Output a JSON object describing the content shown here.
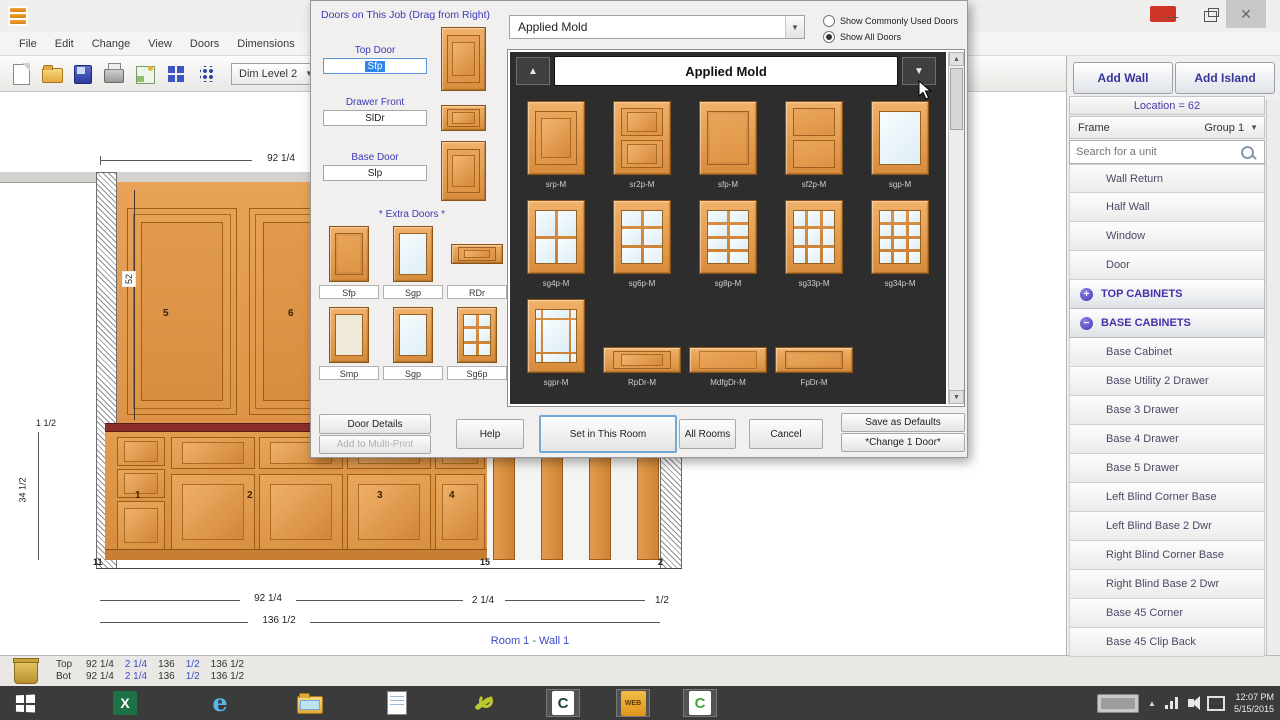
{
  "window": {
    "menu": [
      "File",
      "Edit",
      "Change",
      "View",
      "Doors",
      "Dimensions",
      "C-T"
    ],
    "toolbar": {
      "dim_level": "Dim Level 2",
      "icons": [
        "new-document",
        "open-folder",
        "save-project",
        "print",
        "preview",
        "door-catalog",
        "settings-dots"
      ]
    },
    "controls": {
      "minimize": "—",
      "close": "✕"
    }
  },
  "dialog": {
    "title": "Doors on This Job (Drag from Right)",
    "fields": [
      {
        "label": "Top Door",
        "value": "Sfp"
      },
      {
        "label": "Drawer Front",
        "value": "SlDr"
      },
      {
        "label": "Base Door",
        "value": "Slp"
      }
    ],
    "extra_doors_title": "* Extra Doors *",
    "extra_doors": [
      {
        "label": "Sfp",
        "style": "flat"
      },
      {
        "label": "Sgp",
        "style": "glass"
      },
      {
        "label": "RDr",
        "style": "drawer-raised"
      },
      {
        "label": "Smp",
        "style": "panel-light"
      },
      {
        "label": "Sgp",
        "style": "glass"
      },
      {
        "label": "Sg6p",
        "style": "glassgrid",
        "panes": [
          2,
          3
        ]
      }
    ],
    "left_buttons": [
      {
        "label": "Door Details"
      },
      {
        "label": "Add to Multi-Print"
      }
    ],
    "style_dropdown": "Applied Mold",
    "radios": [
      {
        "label": "Show Commonly Used Doors",
        "checked": false
      },
      {
        "label": "Show All Doors",
        "checked": true
      }
    ],
    "catalog": {
      "header": "Applied Mold",
      "doors": [
        {
          "label": "srp-M",
          "style": "raised"
        },
        {
          "label": "sr2p-M",
          "style": "raised2"
        },
        {
          "label": "sfp-M",
          "style": "flat"
        },
        {
          "label": "sf2p-M",
          "style": "flat2"
        },
        {
          "label": "sgp-M",
          "style": "glass"
        },
        {
          "label": "sg4p-M",
          "style": "glassgrid",
          "panes": [
            2,
            2
          ]
        },
        {
          "label": "sg6p-M",
          "style": "glassgrid",
          "panes": [
            2,
            3
          ]
        },
        {
          "label": "sg8p-M",
          "style": "glassgrid",
          "panes": [
            2,
            4
          ]
        },
        {
          "label": "sg33p-M",
          "style": "glassgrid",
          "panes": [
            3,
            3
          ]
        },
        {
          "label": "sg34p-M",
          "style": "glassgrid",
          "panes": [
            3,
            4
          ]
        },
        {
          "label": "sgpr-M",
          "style": "prairie"
        },
        {
          "label": "RpDr-M",
          "style": "drawer-raised"
        },
        {
          "label": "MdfgDr-M",
          "style": "drawer-slab"
        },
        {
          "label": "FpDr-M",
          "style": "drawer-flat"
        }
      ]
    },
    "bottom_buttons": [
      {
        "label": "Help"
      },
      {
        "label": "Set in This Room"
      },
      {
        "label": "All Rooms"
      },
      {
        "label": "Cancel"
      }
    ],
    "right_buttons": [
      {
        "label": "Save as Defaults"
      },
      {
        "label": "*Change 1 Door*"
      }
    ]
  },
  "sidebar": {
    "add_wall": "Add Wall",
    "add_island": "Add Island",
    "location": "Location = 62",
    "frame_label": "Frame",
    "group": "Group 1",
    "search_placeholder": "Search for a unit",
    "items": [
      "Wall Return",
      "Half Wall",
      "Window",
      "Door"
    ],
    "sections": [
      {
        "label": "TOP CABINETS",
        "expanded": false,
        "items": []
      },
      {
        "label": "BASE CABINETS",
        "expanded": true,
        "items": [
          "Base Cabinet",
          "Base Utility 2 Drawer",
          "Base 3 Drawer",
          "Base 4 Drawer",
          "Base 5 Drawer",
          "Left Blind Corner Base",
          "Left Blind Base 2 Dwr",
          "Right Blind Corner Base",
          "Right Blind Base 2 Dwr",
          "Base 45 Corner",
          "Base 45 Clip Back"
        ]
      }
    ]
  },
  "drawing": {
    "top_dim": "92 1/4",
    "upper_height_label": "52",
    "counter_dim": "1 1/2",
    "base_height_dim": "34 1/2",
    "inner_base_label": "34 1/2",
    "upper_numbers": [
      "5",
      "6"
    ],
    "base_numbers": [
      "1",
      "2",
      "3",
      "4"
    ],
    "floor_labels": [
      "11",
      "15",
      "2"
    ],
    "bottom_dim1": "92 1/4",
    "bottom_dim2": "2 1/4",
    "bottom_dim3": "1/2",
    "bottom_dim4": "136 1/2",
    "caption": "Room 1  -  Wall 1"
  },
  "statusbar": {
    "rows": [
      {
        "label": "Top",
        "segs": [
          {
            "t": "92 1/4",
            "b": false
          },
          {
            "t": "2 1/4",
            "b": true
          },
          {
            "t": "136",
            "b": false
          },
          {
            "t": "1/2",
            "b": true
          },
          {
            "t": "136 1/2",
            "b": false
          }
        ]
      },
      {
        "label": "Bot",
        "segs": [
          {
            "t": "92 1/4",
            "b": false
          },
          {
            "t": "2 1/4",
            "b": true
          },
          {
            "t": "136",
            "b": false
          },
          {
            "t": "1/2",
            "b": true
          },
          {
            "t": "136 1/2",
            "b": false
          }
        ]
      }
    ]
  },
  "taskbar": {
    "icons": [
      "start",
      "excel",
      "internet-explorer",
      "file-explorer",
      "notepad",
      "wrench-tool",
      "cabinet-app",
      "web-app",
      "cabinet-green"
    ],
    "time": "12:07 PM",
    "date": "5/15/2015"
  }
}
